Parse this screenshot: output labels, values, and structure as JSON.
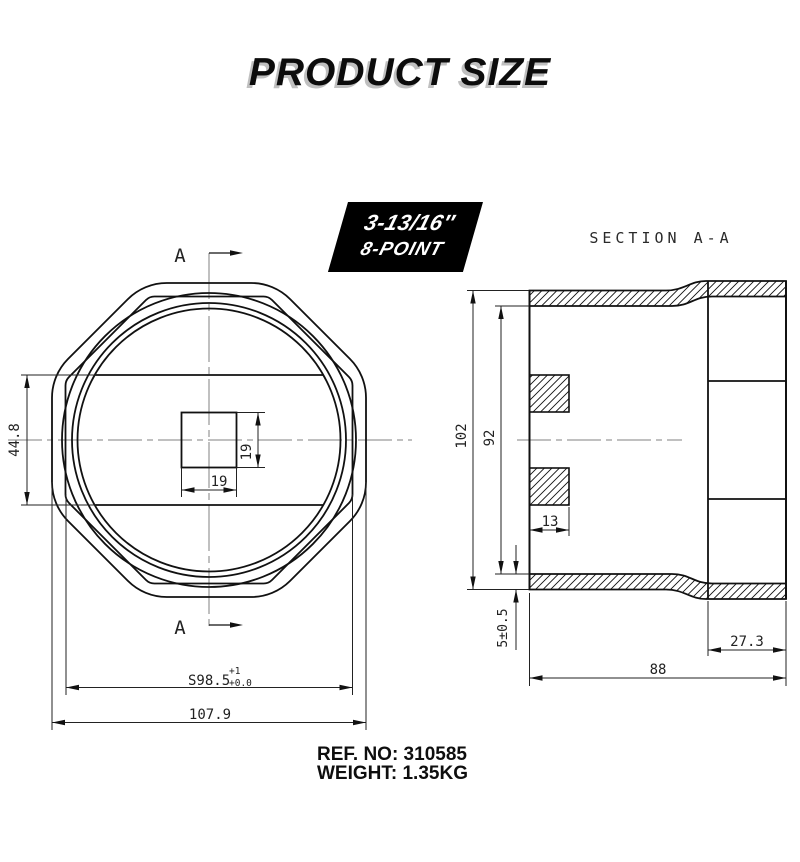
{
  "title": "PRODUCT SIZE",
  "badge": {
    "line1": "3-13/16″",
    "line2": "8-POINT"
  },
  "section_label": "SECTION A-A",
  "front_view": {
    "marker_top": "A",
    "marker_bottom": "A",
    "dim_height": "44.8",
    "dim_square_height": "19",
    "dim_square_width": "19",
    "dim_across_flats": "S98.5",
    "dim_across_flats_tol_upper": "+1",
    "dim_across_flats_tol_lower": "+0.0",
    "dim_overall_width": "107.9"
  },
  "section_view": {
    "dim_outer_diameter": "102",
    "dim_inner_diameter": "92",
    "dim_drive_width": "13",
    "dim_wall_thickness": "5±0.5",
    "dim_neck_length": "27.3",
    "dim_overall_length": "88"
  },
  "footer": {
    "ref_no": "REF. NO: 310585",
    "weight": "WEIGHT: 1.35KG"
  },
  "colors": {
    "line": "#111111",
    "dimension": "#222222",
    "centerline": "#828282",
    "badge_bg": "#000000",
    "badge_text": "#ffffff",
    "title_shadow": "#bfbfbf"
  }
}
